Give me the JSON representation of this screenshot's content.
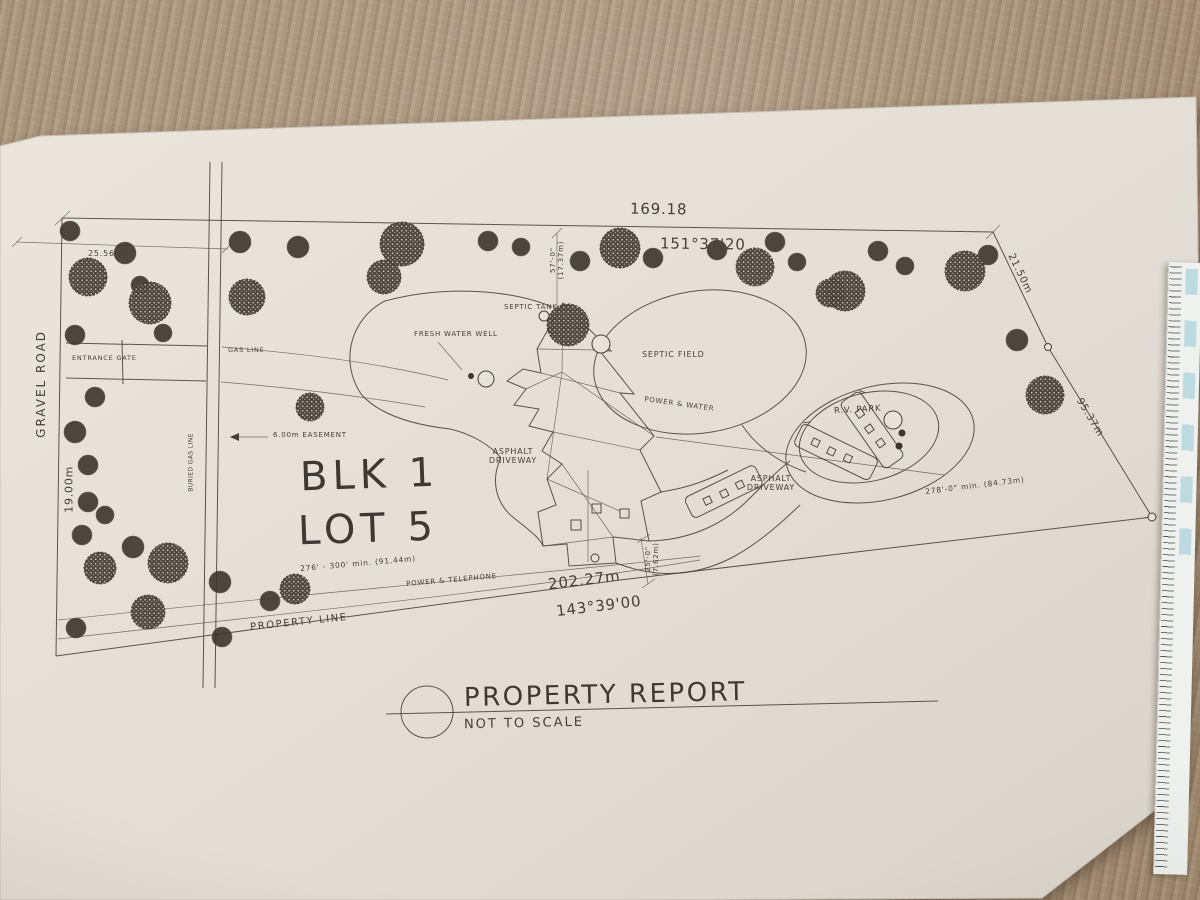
{
  "colors": {
    "carpet": "#a8927a",
    "paper": "#e7e3da",
    "ink": "#45403a"
  },
  "title_block": {
    "title": "PROPERTY REPORT",
    "scale_note": "NOT TO SCALE"
  },
  "lot": {
    "block": "BLK 1",
    "lot": "LOT 5"
  },
  "boundary": {
    "top_length": "169.18",
    "top_bearing": "151°37'20",
    "bottom_length": "202.27m",
    "bottom_bearing": "143°39'00",
    "left_width": "19.00m",
    "right_upper": "21.50m",
    "right_lower": "95.37m",
    "top_left_offset": "25.56m",
    "southwest_note": "276' - 300' min. (91.44m)",
    "southeast_note": "278'-0\" min. (84.73m)",
    "property_line_label": "PROPERTY LINE"
  },
  "setbacks": {
    "north_imperial": "57'-0\"",
    "north_metric": "(17.37m)",
    "south_imperial": "25'-0\"",
    "south_metric": "(7.62m)"
  },
  "features": {
    "gravel_road": "GRAVEL ROAD",
    "entrance_gate": "ENTRANCE GATE",
    "gas_line": "GAS LINE",
    "buried_gas_line": "BURIED GAS LINE",
    "easement": "6.00m EASEMENT",
    "fresh_water_well": "FRESH WATER WELL",
    "septic_tank": "SEPTIC TANK",
    "septic_field": "SEPTIC FIELD",
    "power_water": "POWER & WATER",
    "rv_park": "R.V. PARK",
    "asphalt_1": "ASPHALT",
    "asphalt_2": "DRIVEWAY",
    "power_telephone": "POWER & TELEPHONE"
  },
  "trees": [
    {
      "x": 70,
      "y": 231,
      "r": 10,
      "t": "s"
    },
    {
      "x": 125,
      "y": 253,
      "r": 11,
      "t": "s"
    },
    {
      "x": 240,
      "y": 242,
      "r": 11,
      "t": "s"
    },
    {
      "x": 298,
      "y": 247,
      "r": 11,
      "t": "s"
    },
    {
      "x": 488,
      "y": 241,
      "r": 10,
      "t": "s"
    },
    {
      "x": 521,
      "y": 247,
      "r": 9,
      "t": "s"
    },
    {
      "x": 580,
      "y": 261,
      "r": 10,
      "t": "s"
    },
    {
      "x": 653,
      "y": 258,
      "r": 10,
      "t": "s"
    },
    {
      "x": 717,
      "y": 250,
      "r": 10,
      "t": "s"
    },
    {
      "x": 775,
      "y": 242,
      "r": 10,
      "t": "s"
    },
    {
      "x": 797,
      "y": 262,
      "r": 9,
      "t": "s"
    },
    {
      "x": 878,
      "y": 251,
      "r": 10,
      "t": "s"
    },
    {
      "x": 905,
      "y": 266,
      "r": 9,
      "t": "s"
    },
    {
      "x": 988,
      "y": 255,
      "r": 10,
      "t": "s"
    },
    {
      "x": 1017,
      "y": 340,
      "r": 11,
      "t": "s"
    },
    {
      "x": 163,
      "y": 333,
      "r": 9,
      "t": "s"
    },
    {
      "x": 75,
      "y": 335,
      "r": 10,
      "t": "s"
    },
    {
      "x": 95,
      "y": 397,
      "r": 10,
      "t": "s"
    },
    {
      "x": 75,
      "y": 432,
      "r": 11,
      "t": "s"
    },
    {
      "x": 88,
      "y": 465,
      "r": 10,
      "t": "s"
    },
    {
      "x": 88,
      "y": 502,
      "r": 10,
      "t": "s"
    },
    {
      "x": 105,
      "y": 515,
      "r": 9,
      "t": "s"
    },
    {
      "x": 82,
      "y": 535,
      "r": 10,
      "t": "s"
    },
    {
      "x": 133,
      "y": 547,
      "r": 11,
      "t": "s"
    },
    {
      "x": 220,
      "y": 582,
      "r": 11,
      "t": "s"
    },
    {
      "x": 270,
      "y": 601,
      "r": 10,
      "t": "s"
    },
    {
      "x": 76,
      "y": 628,
      "r": 10,
      "t": "s"
    },
    {
      "x": 222,
      "y": 637,
      "r": 10,
      "t": "s"
    },
    {
      "x": 140,
      "y": 285,
      "r": 9,
      "t": "s"
    },
    {
      "x": 88,
      "y": 277,
      "r": 19,
      "t": "r"
    },
    {
      "x": 150,
      "y": 303,
      "r": 21,
      "t": "r"
    },
    {
      "x": 247,
      "y": 297,
      "r": 18,
      "t": "r"
    },
    {
      "x": 384,
      "y": 277,
      "r": 17,
      "t": "r"
    },
    {
      "x": 402,
      "y": 244,
      "r": 22,
      "t": "r"
    },
    {
      "x": 620,
      "y": 248,
      "r": 20,
      "t": "r"
    },
    {
      "x": 755,
      "y": 267,
      "r": 19,
      "t": "r"
    },
    {
      "x": 845,
      "y": 291,
      "r": 20,
      "t": "r"
    },
    {
      "x": 965,
      "y": 271,
      "r": 20,
      "t": "r"
    },
    {
      "x": 1045,
      "y": 395,
      "r": 19,
      "t": "r"
    },
    {
      "x": 310,
      "y": 407,
      "r": 14,
      "t": "r"
    },
    {
      "x": 168,
      "y": 563,
      "r": 20,
      "t": "r"
    },
    {
      "x": 100,
      "y": 568,
      "r": 16,
      "t": "r"
    },
    {
      "x": 148,
      "y": 612,
      "r": 17,
      "t": "r"
    },
    {
      "x": 295,
      "y": 589,
      "r": 15,
      "t": "r"
    },
    {
      "x": 568,
      "y": 325,
      "r": 21,
      "t": "r"
    },
    {
      "x": 830,
      "y": 293,
      "r": 14,
      "t": "r"
    }
  ]
}
